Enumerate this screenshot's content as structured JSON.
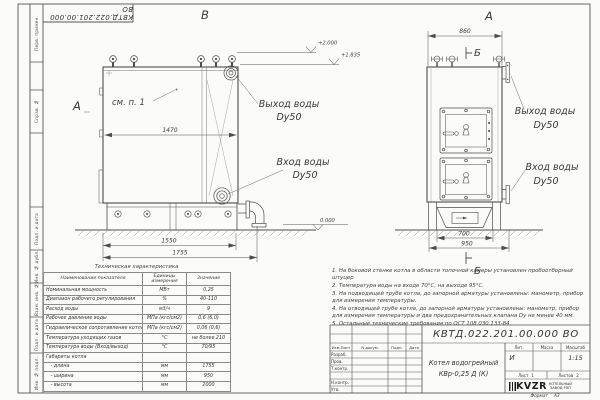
{
  "frame": {
    "doc_number_rotated": "КВТД.022.201.00.000 ВО",
    "stamps": [
      "Перв. примен.",
      "Справ. №",
      "Подп. и дата",
      "Инв. № дубл.",
      "Взам. инв. №",
      "Подп. и дата",
      "Инв. № подл."
    ],
    "format_label": "Формат",
    "format_value": "А3"
  },
  "drawing": {
    "view_b_label": "В",
    "view_a_label": "А",
    "arrow_a_label": "А",
    "see_note": "см. п. 1",
    "section_b_top": "Б",
    "section_b_bottom": "Б",
    "dims": {
      "d1470": "1470",
      "d1550": "1550",
      "d1755": "1755",
      "d860": "860",
      "d700": "700",
      "d950": "950"
    },
    "elevations": {
      "top": "+2.000",
      "mid": "+1.835",
      "zero": "0.000"
    },
    "water_out_1": "Выход воды",
    "water_out_2": "Dy50",
    "water_in_1": "Вход воды",
    "water_in_2": "Dy50"
  },
  "spec_table": {
    "title": "Техническая характеристика",
    "headers": [
      "Наименование показателя",
      "Единицы измерения",
      "Значение"
    ],
    "rows": [
      [
        "Номинальная мощность",
        "МВт",
        "0,25"
      ],
      [
        "Диапазон рабочего регулирования",
        "%",
        "40-110"
      ],
      [
        "Расход воды",
        "м3/ч",
        "9"
      ],
      [
        "Рабочее давление воды",
        "МПа (кгс/см2)",
        "0,6 (6,0)"
      ],
      [
        "Гидравлическое сопротивление котла",
        "МПа (кгс/см2)",
        "0,06 (0,6)"
      ],
      [
        "Температура уходящих газов",
        "°С",
        "не более 210"
      ],
      [
        "Температура воды (Вход/выход)",
        "°С",
        "70/95"
      ],
      [
        "Габариты котла",
        "",
        ""
      ],
      [
        "   - длина",
        "мм",
        "1755"
      ],
      [
        "   - ширина",
        "мм",
        "950"
      ],
      [
        "   - высота",
        "мм",
        "2000"
      ]
    ]
  },
  "notes": [
    "1.  На боковой стенке котла в области топочной камеры установлен пробоотборный штуцер",
    "2.  Температура воды на входе 70°С, на выходе 95°С.",
    "3.  На подводящей трубе котла, до запорной арматуры установлены: манометр, прибор для измерения температуры.",
    "4.  На отводящей трубе котла, до запорной арматуры установлены: манометр, прибор для измерения температуры и два предохранительных клапана Dy не менее 40 мм.",
    "5.  Остальные технические требования по ОСТ 108.030.133-84."
  ],
  "title_block": {
    "doc_number": "КВТД.022.201.00.000  ВО",
    "header_cols": [
      "Изм.Лист",
      "N докум.",
      "Подп.",
      "Дата"
    ],
    "role_rows": [
      "Разраб.",
      "Пров.",
      "Т.контр.",
      "Н.контр.",
      "Утв."
    ],
    "product_name_line1": "Котел водогрейный",
    "product_name_line2": "КВр-0,25 Д (К)",
    "lit_label": "Лит.",
    "lit_value": "И",
    "mass_label": "Масса",
    "scale_label": "Масштаб",
    "scale_value": "1:15",
    "sheet_label": "Лист",
    "sheet_value": "1",
    "sheets_label": "Листов",
    "sheets_value": "2",
    "company_logo": "KVZR",
    "company_line1": "КОТЕЛЬНЫЙ",
    "company_line2": "ЗАВОД РЭП"
  }
}
